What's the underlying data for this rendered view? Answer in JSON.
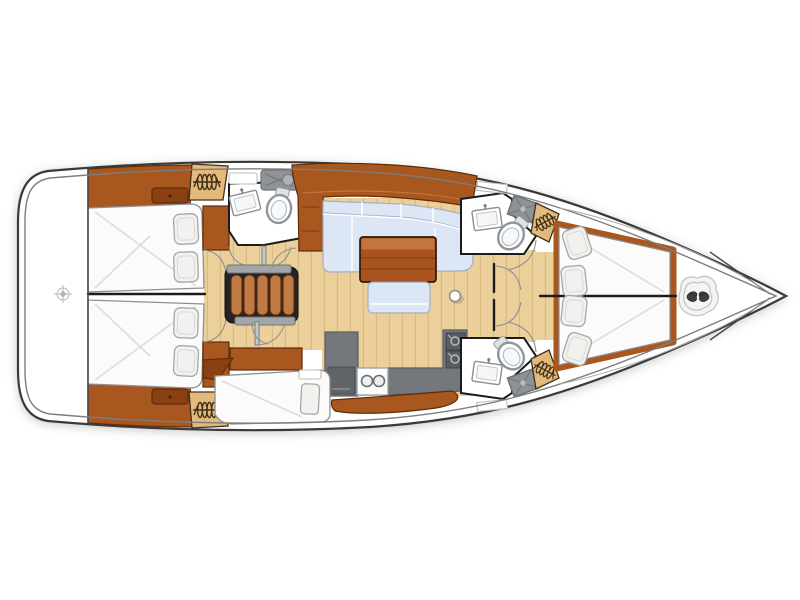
{
  "diagram": {
    "type": "sailing-yacht-interior-floor-plan",
    "view": "top-down",
    "orientation": {
      "bow": "right",
      "stern": "left"
    },
    "rooms": [
      {
        "id": "swim-platform",
        "name": "Transom / swim platform",
        "position": "aft",
        "features": [
          "steering-fitting mark"
        ]
      },
      {
        "id": "aft-cabin-top",
        "name": "Aft double cabin (upper)",
        "furniture": [
          "double berth",
          "2 pillows",
          "hanging locker",
          "locker panel"
        ]
      },
      {
        "id": "aft-cabin-bottom",
        "name": "Aft double cabin (lower)",
        "furniture": [
          "double berth",
          "2 pillows",
          "hanging locker",
          "locker panel"
        ]
      },
      {
        "id": "aft-head",
        "name": "Aft head compartment (upper)",
        "furniture": [
          "toilet",
          "washbasin",
          "vanity unit",
          "shelf"
        ]
      },
      {
        "id": "companionway",
        "name": "Companionway steps",
        "detail": "5 wooden treads with handrail caps and doors"
      },
      {
        "id": "saloon",
        "name": "Saloon",
        "furniture": [
          "L-shaped settee",
          "wooden dining table",
          "ottoman"
        ]
      },
      {
        "id": "galley",
        "name": "Galley",
        "furniture": [
          "refrigerator",
          "2-burner stove",
          "L-shaped worktop",
          "double sink"
        ]
      },
      {
        "id": "lower-berth",
        "name": "Berth / seat (lower, beside galley)",
        "furniture": [
          "cushioned berth",
          "pillow",
          "shelf"
        ]
      },
      {
        "id": "fwd-head-top",
        "name": "Forward head (upper)",
        "furniture": [
          "toilet",
          "washbasin",
          "shower pan",
          "shelf"
        ]
      },
      {
        "id": "fwd-head-bottom",
        "name": "Forward head (lower)",
        "furniture": [
          "toilet",
          "washbasin",
          "shower pan",
          "shelf"
        ]
      },
      {
        "id": "owner-cabin",
        "name": "Forward owner's cabin",
        "furniture": [
          "V-shaped double berth",
          "4 pillows",
          "2 hanging lockers",
          "wood floor strip"
        ]
      },
      {
        "id": "foredeck",
        "name": "Foredeck / anchor well",
        "furniture": [
          "windlass"
        ]
      }
    ],
    "symbols": [
      "mast-post dot",
      "door swing arcs",
      "hanging-locker coil marks",
      "berth centerlines",
      "bow anchor-well V lines"
    ]
  },
  "colors": {
    "hull_line": "#3a3a3a",
    "hull_inner_line": "#7d7d7d",
    "deck_line": "#a9a9a9",
    "wall": "#1b1b1b",
    "wood": "#a8571f",
    "wood_light": "#c07a43",
    "wood_dark": "#8a4012",
    "wood_edge": "#5f2c0a",
    "floor": "#ecd09c",
    "floor_line": "#d9ba80",
    "locker": "#e3b97c",
    "locker_mark": "#41301a",
    "upholstery": "#dce6f4",
    "upholstery_edge": "#a3b0c4",
    "table_top": "#c3753d",
    "table_body": "#a9541e",
    "table_line": "#7e3c12",
    "counter": "#74777b",
    "counter_dark": "#595d61",
    "appliance": "#606468",
    "bed": "#fbfbfb",
    "bed_edge": "#8f8f8f",
    "bed_sheen": "#dcdcde",
    "pillow": "#f1f1ef",
    "pillow_edge": "#a7a7a3",
    "fixture": "#ffffff",
    "fixture_ring": "#8f969b",
    "door_arc": "#8f8f8f",
    "door_leaf": "#c3c7ca"
  }
}
